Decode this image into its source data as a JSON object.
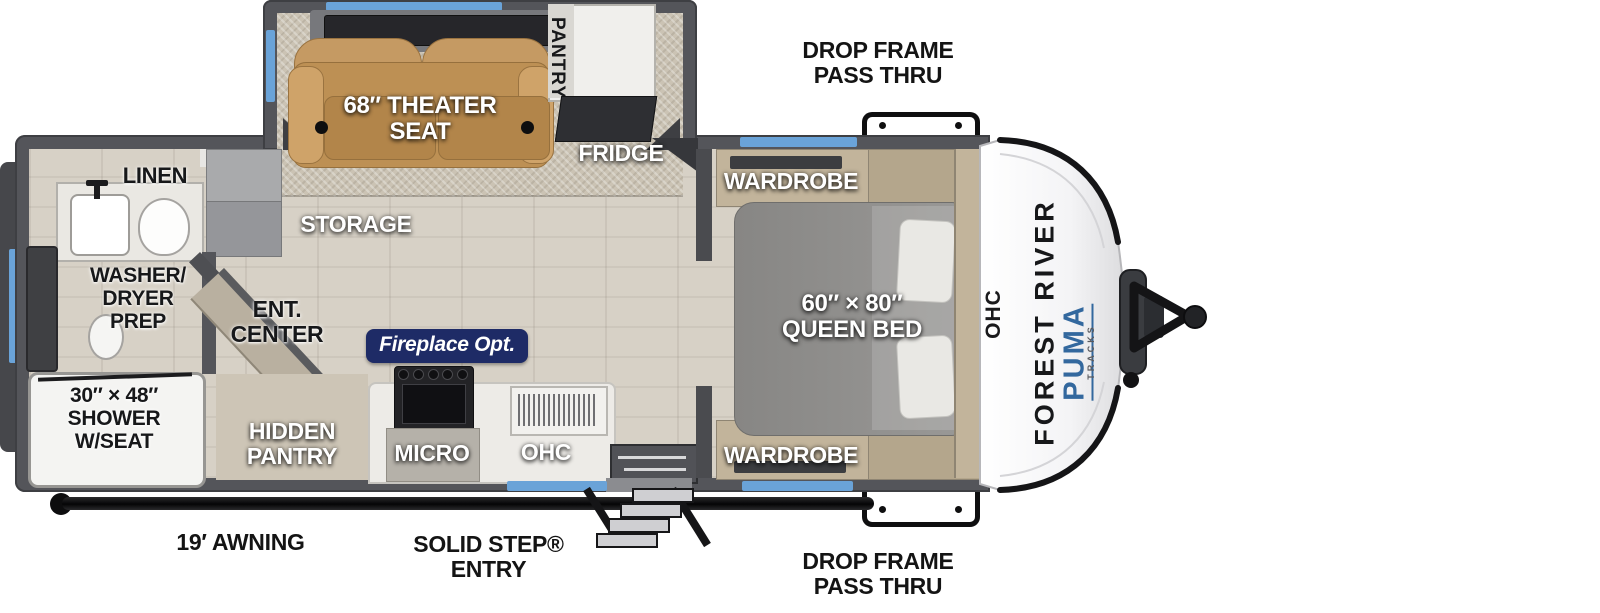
{
  "title": "Travel trailer floor plan",
  "colors": {
    "window": "#6aa3d8",
    "badge": "#1e2b66",
    "brand_blue": "#33689e",
    "wall": "#54555a",
    "seat": "#c59a63",
    "cabinet": "#c2b49b",
    "bed": "#8e8d8b",
    "floor": "#d7d1c6",
    "carpet": "#cbc3b4"
  },
  "exterior": {
    "drop_frame_top": "DROP FRAME\nPASS THRU",
    "drop_frame_bottom": "DROP FRAME\nPASS THRU",
    "awning": "19′ AWNING",
    "entry": "SOLID STEP®\nENTRY"
  },
  "branding": {
    "manufacturer": "FOREST RIVER",
    "model": "PUMA",
    "model_sub": "TRACKS"
  },
  "bathroom": {
    "linen": "LINEN",
    "washer_dryer": "WASHER/\nDRYER\nPREP",
    "shower": "30″ × 48″\nSHOWER\nW/SEAT"
  },
  "living": {
    "theater_seat": "68″ THEATER\nSEAT",
    "pantry": "PANTRY",
    "fridge": "FRIDGE",
    "storage": "STORAGE",
    "ent_center": "ENT.\nCENTER",
    "hidden_pantry": "HIDDEN\nPANTRY",
    "fireplace": "Fireplace Opt."
  },
  "kitchen": {
    "micro": "MICRO",
    "ohc": "OHC"
  },
  "bedroom": {
    "wardrobe_top": "WARDROBE",
    "wardrobe_bottom": "WARDROBE",
    "queen_bed": "60″ × 80″\nQUEEN BED",
    "ohc": "OHC"
  }
}
